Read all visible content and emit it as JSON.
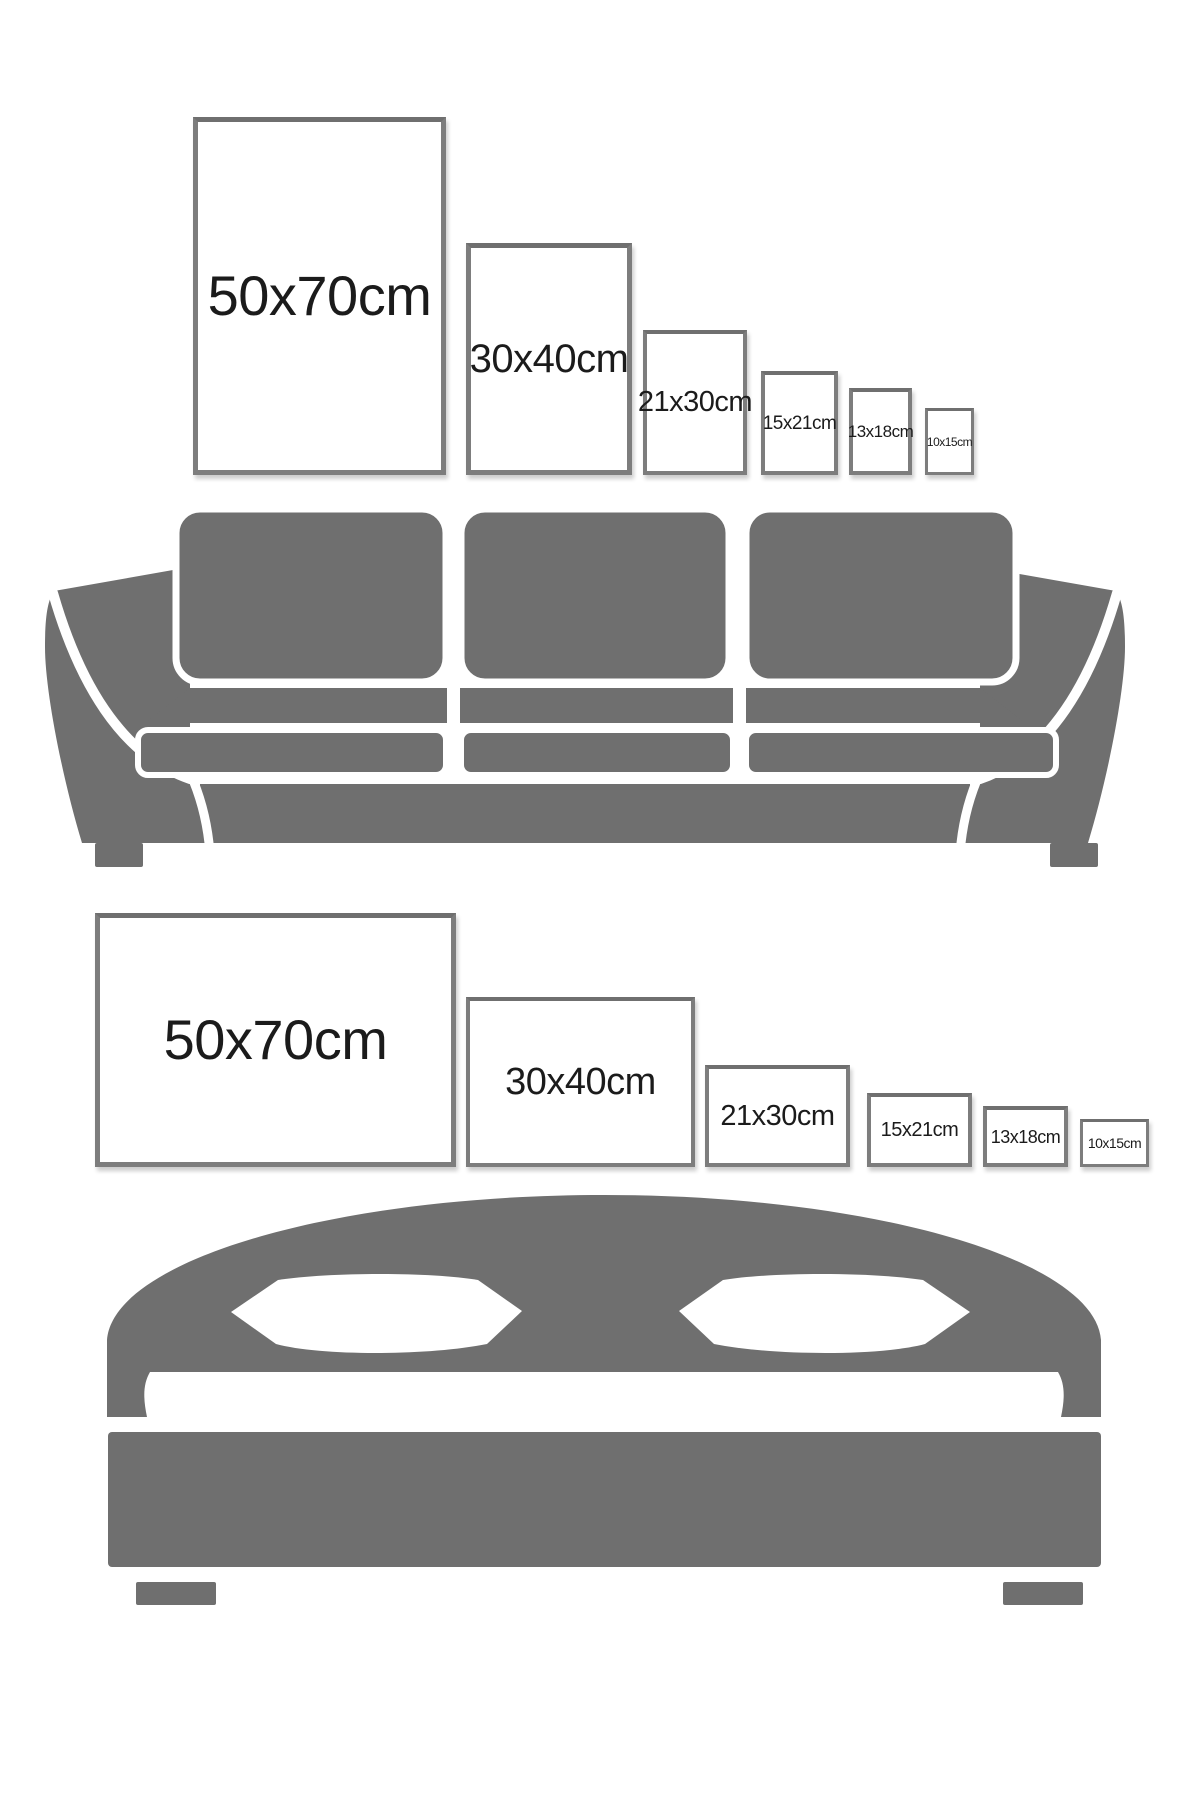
{
  "title": "Poster size comparison guide",
  "colors": {
    "background": "#ffffff",
    "furniture": "#6f6f6f",
    "frame_border": "#7d7d7d",
    "frame_border_top": "#6f6f6f",
    "frame_face": "#ffffff",
    "label_text": "#1b1b1b"
  },
  "sections": [
    {
      "id": "sofa",
      "furniture": "sofa",
      "frame_orientation": "portrait",
      "frames": [
        {
          "label": "50x70cm",
          "x": 193,
          "y": 117,
          "w": 253,
          "h": 358,
          "font": 56,
          "border": 5
        },
        {
          "label": "30x40cm",
          "x": 466,
          "y": 243,
          "w": 166,
          "h": 232,
          "font": 40,
          "border": 5
        },
        {
          "label": "21x30cm",
          "x": 643,
          "y": 330,
          "w": 104,
          "h": 145,
          "font": 29,
          "border": 4
        },
        {
          "label": "15x21cm",
          "x": 761,
          "y": 371,
          "w": 77,
          "h": 104,
          "font": 19,
          "border": 4
        },
        {
          "label": "13x18cm",
          "x": 849,
          "y": 388,
          "w": 63,
          "h": 87,
          "font": 17,
          "border": 4
        },
        {
          "label": "10x15cm",
          "x": 925,
          "y": 408,
          "w": 49,
          "h": 67,
          "font": 12,
          "border": 3
        }
      ]
    },
    {
      "id": "bed",
      "furniture": "bed",
      "frame_orientation": "landscape",
      "frames": [
        {
          "label": "50x70cm",
          "x": 95,
          "y": 913,
          "w": 361,
          "h": 254,
          "font": 56,
          "border": 5
        },
        {
          "label": "30x40cm",
          "x": 466,
          "y": 997,
          "w": 229,
          "h": 170,
          "font": 38,
          "border": 4
        },
        {
          "label": "21x30cm",
          "x": 705,
          "y": 1065,
          "w": 145,
          "h": 102,
          "font": 29,
          "border": 4
        },
        {
          "label": "15x21cm",
          "x": 867,
          "y": 1093,
          "w": 105,
          "h": 74,
          "font": 20,
          "border": 4
        },
        {
          "label": "13x18cm",
          "x": 983,
          "y": 1106,
          "w": 85,
          "h": 61,
          "font": 18,
          "border": 4
        },
        {
          "label": "10x15cm",
          "x": 1080,
          "y": 1119,
          "w": 69,
          "h": 48,
          "font": 14,
          "border": 3
        }
      ]
    }
  ]
}
